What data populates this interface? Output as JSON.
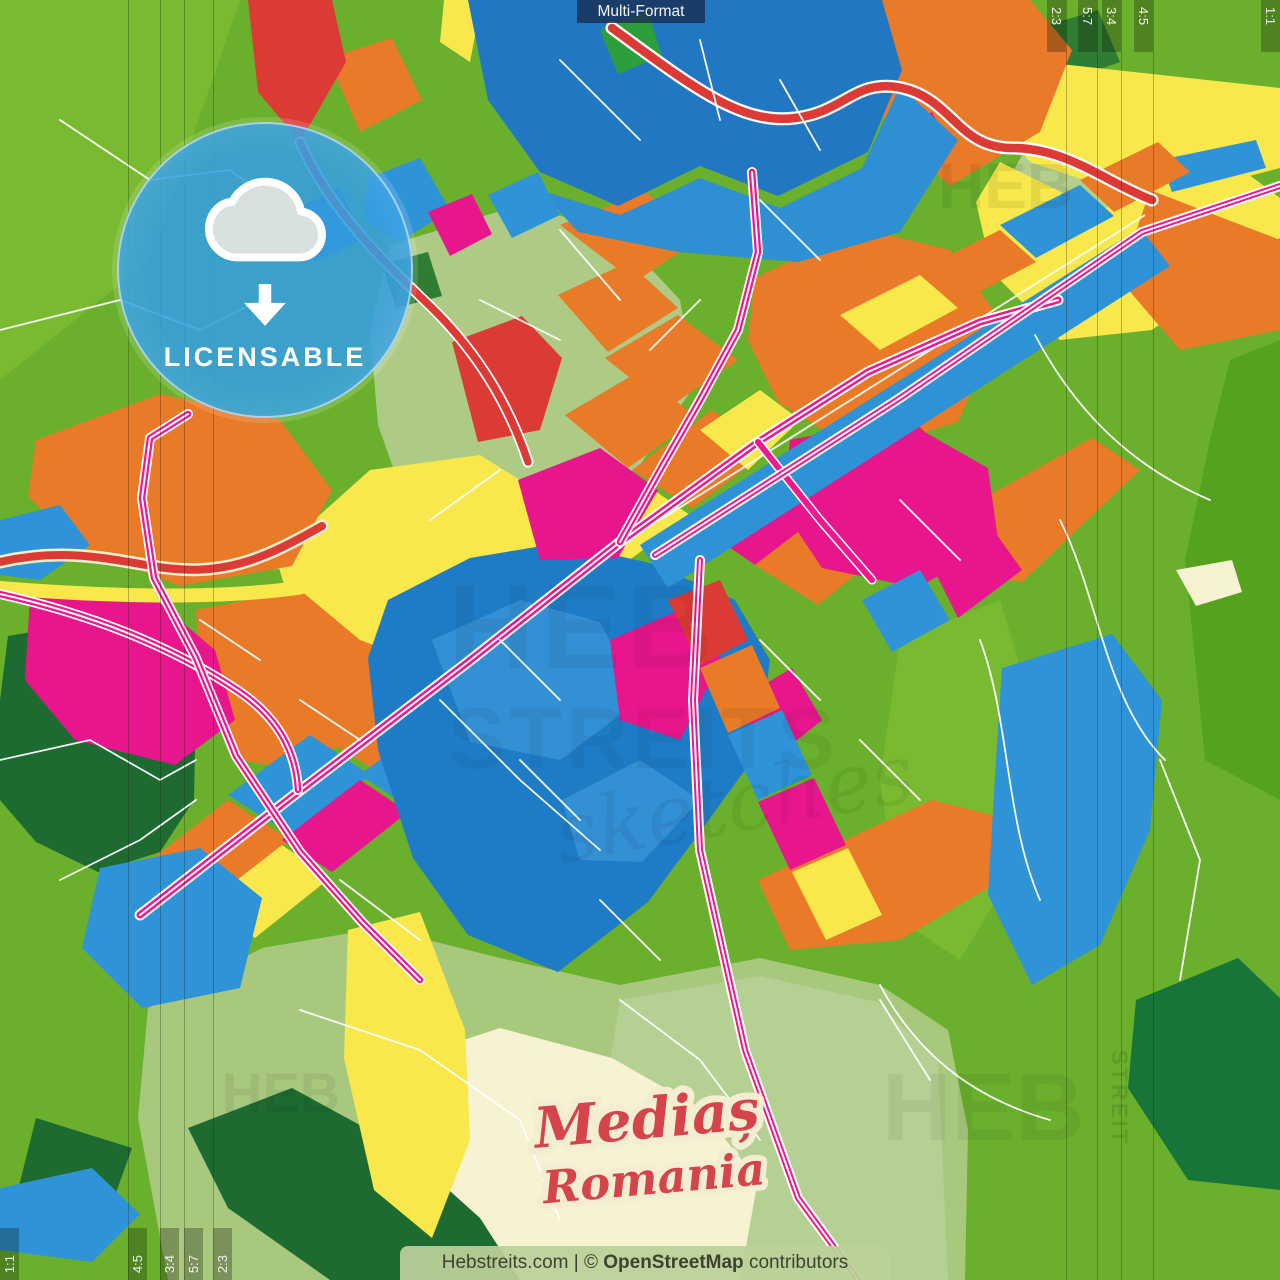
{
  "header": {
    "format_label": "Multi-Format"
  },
  "ratios": {
    "top_right": [
      "2:3",
      "5:7",
      "3:4",
      "4:5",
      "1:1"
    ],
    "bottom_left": [
      "1:1",
      "4:5",
      "3:4",
      "5:7",
      "2:3"
    ]
  },
  "badge": {
    "label": "LICENSABLE",
    "icon": "cloud-download-icon"
  },
  "title": {
    "city": "Mediaș",
    "country": "Romania"
  },
  "watermarks": {
    "brand": "HEB",
    "brand2": "STREITS",
    "script": "sketches",
    "vertical": "STREIT"
  },
  "footer": {
    "prefix": "Hebstreits.com | © ",
    "osm": "OpenStreetMap",
    "suffix": " contributors"
  },
  "colors": {
    "base_green": "#6ab02c",
    "light_green": "#79ba31",
    "deep_green": "#55a21f",
    "forest_green": "#1d6b31",
    "sage_green": "#aecb86",
    "cream": "#f7f2d2",
    "yellow": "#f8e84b",
    "orange": "#e87a28",
    "red": "#dc3a35",
    "magenta": "#e8168c",
    "road_magenta": "#ec1a8e",
    "blue_dark": "#2277c2",
    "blue": "#1e7cc6",
    "blue_mid": "#2f93d8",
    "blue_light": "#3390d4",
    "badge_blue": "#34a0e0",
    "title_red": "#d6444b",
    "title_outline": "#f3edd2",
    "band_bg": "rgba(15,22,6,0.30)",
    "chip_bg": "rgba(24,44,78,0.78)",
    "footer_bg": "rgba(186,209,152,0.93)",
    "footer_text": "#3d4330"
  }
}
